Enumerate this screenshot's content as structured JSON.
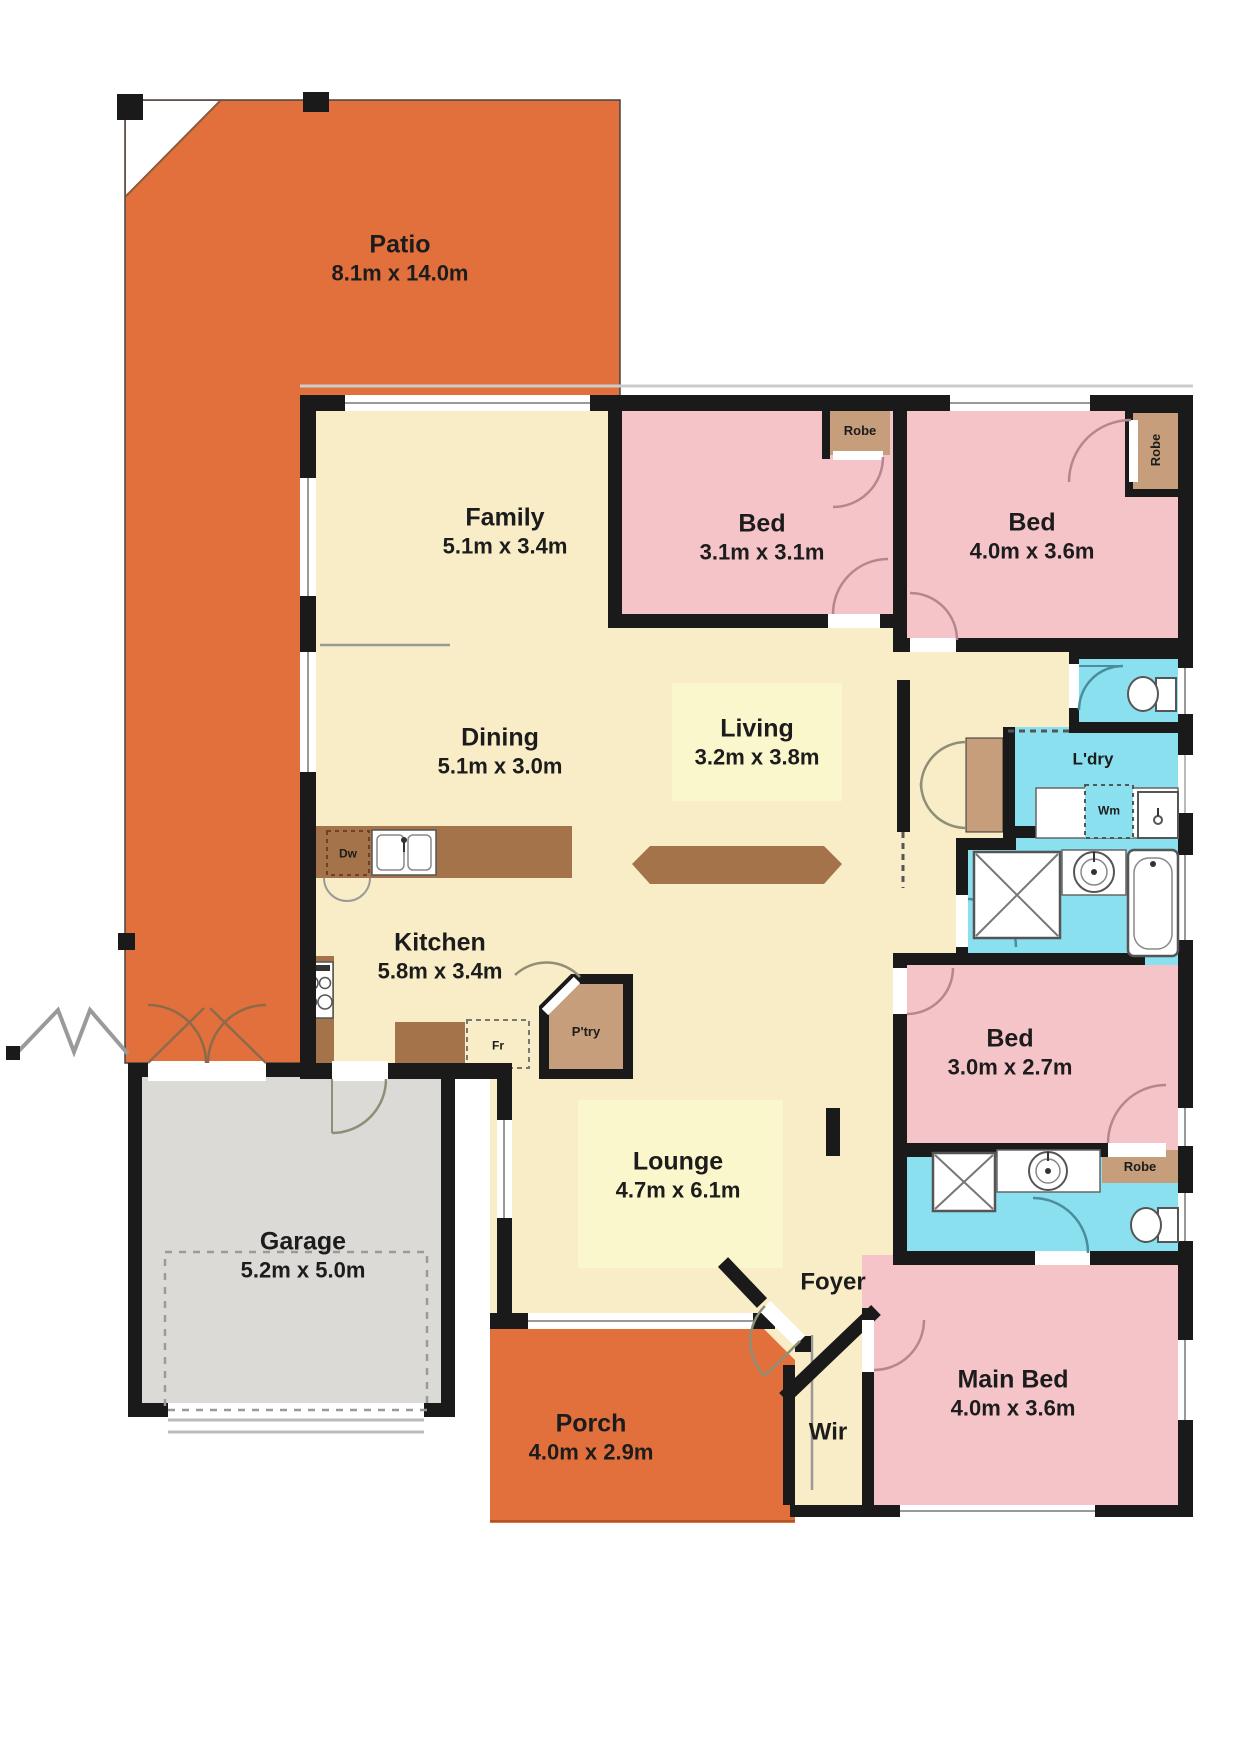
{
  "plan_title": "Residential floor plan",
  "colors": {
    "outdoor_orange": "#E2703C",
    "floor_cream": "#F8EDC6",
    "bedroom_pink": "#F5C4C9",
    "wet_area_blue": "#8BE0F0",
    "garage_grey": "#DBDAD6",
    "joinery_tan": "#C79E7B",
    "bench_brown": "#A5734A",
    "wall_black": "#1A1A1A",
    "label_highlight": "#FBF7CC"
  },
  "rooms": {
    "patio": {
      "name": "Patio",
      "dims": "8.1m x 14.0m"
    },
    "family": {
      "name": "Family",
      "dims": "5.1m x 3.4m"
    },
    "dining": {
      "name": "Dining",
      "dims": "5.1m x 3.0m"
    },
    "kitchen": {
      "name": "Kitchen",
      "dims": "5.8m x 3.4m"
    },
    "living": {
      "name": "Living",
      "dims": "3.2m x 3.8m"
    },
    "lounge": {
      "name": "Lounge",
      "dims": "4.7m x 6.1m"
    },
    "garage": {
      "name": "Garage",
      "dims": "5.2m x 5.0m"
    },
    "porch": {
      "name": "Porch",
      "dims": "4.0m x 2.9m"
    },
    "bed_2": {
      "name": "Bed",
      "dims": "3.1m x 3.1m"
    },
    "bed_3": {
      "name": "Bed",
      "dims": "4.0m x 3.6m"
    },
    "bed_4": {
      "name": "Bed",
      "dims": "3.0m x 2.7m"
    },
    "main_bed": {
      "name": "Main Bed",
      "dims": "4.0m x 3.6m"
    },
    "foyer": {
      "name": "Foyer"
    },
    "wir": {
      "name": "Wir"
    },
    "laundry": {
      "name": "L'dry"
    }
  },
  "fixtures": {
    "robe": "Robe",
    "pantry": "P'try",
    "dishwasher": "Dw",
    "fridge": "Fr",
    "washing_machine": "Wm"
  }
}
